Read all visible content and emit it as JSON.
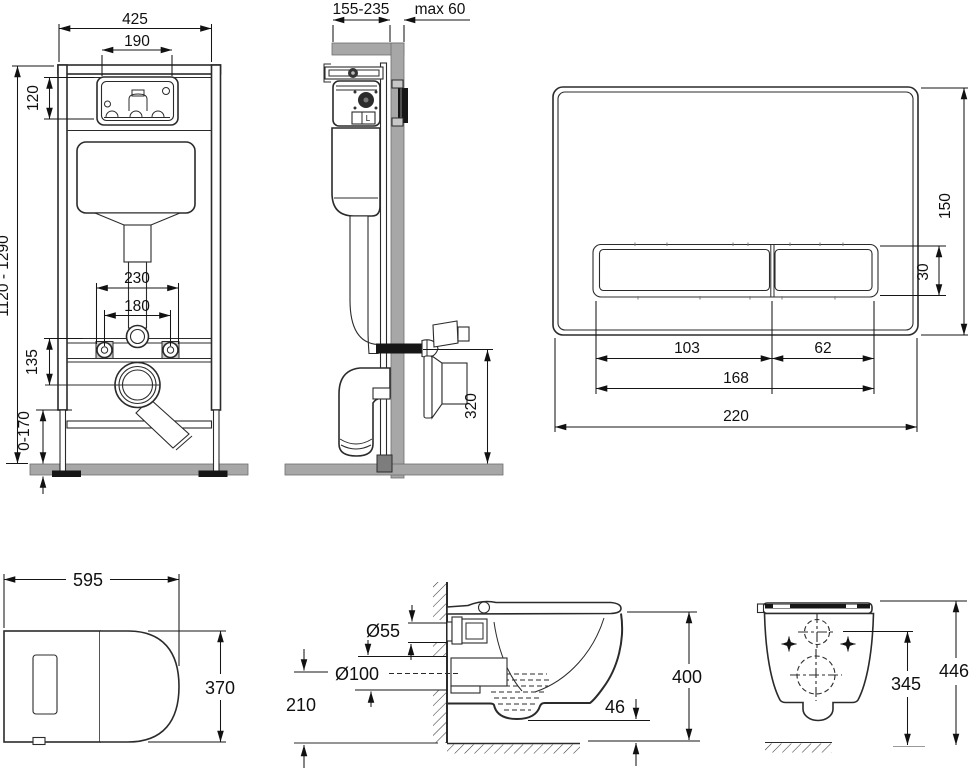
{
  "colors": {
    "line": "#2b2b2b",
    "dim_text": "#101010",
    "masonry_gray": "#a7a7a7",
    "black_fill": "#161616",
    "background": "#ffffff"
  },
  "views": {
    "frame_front": {
      "dims": {
        "overall_width": "425",
        "cutout_width": "190",
        "cutout_height": "120",
        "frame_height": "1120 - 1290",
        "fixing_spread": "230",
        "stud_spread": "180",
        "outlet_drop": "135",
        "base_adjust": "0-170"
      }
    },
    "frame_side": {
      "valve_label": "L",
      "dims": {
        "install_depth": "155-235",
        "wall_thickness": "max 60",
        "outlet_height": "320"
      }
    },
    "flush_plate": {
      "dims": {
        "plate_height": "150",
        "button_height": "30",
        "large_button_width": "103",
        "small_button_width": "62",
        "buttons_width": "168",
        "plate_width": "220"
      }
    },
    "bowl_top": {
      "dims": {
        "length": "595",
        "width": "370"
      }
    },
    "bowl_side": {
      "dims": {
        "inlet_diameter": "Ø55",
        "outlet_diameter": "Ø100",
        "outlet_axis_height": "210",
        "height": "400",
        "trap_offset": "46"
      }
    },
    "bowl_back": {
      "dims": {
        "fixing_height": "345",
        "overall_height": "446"
      }
    }
  }
}
